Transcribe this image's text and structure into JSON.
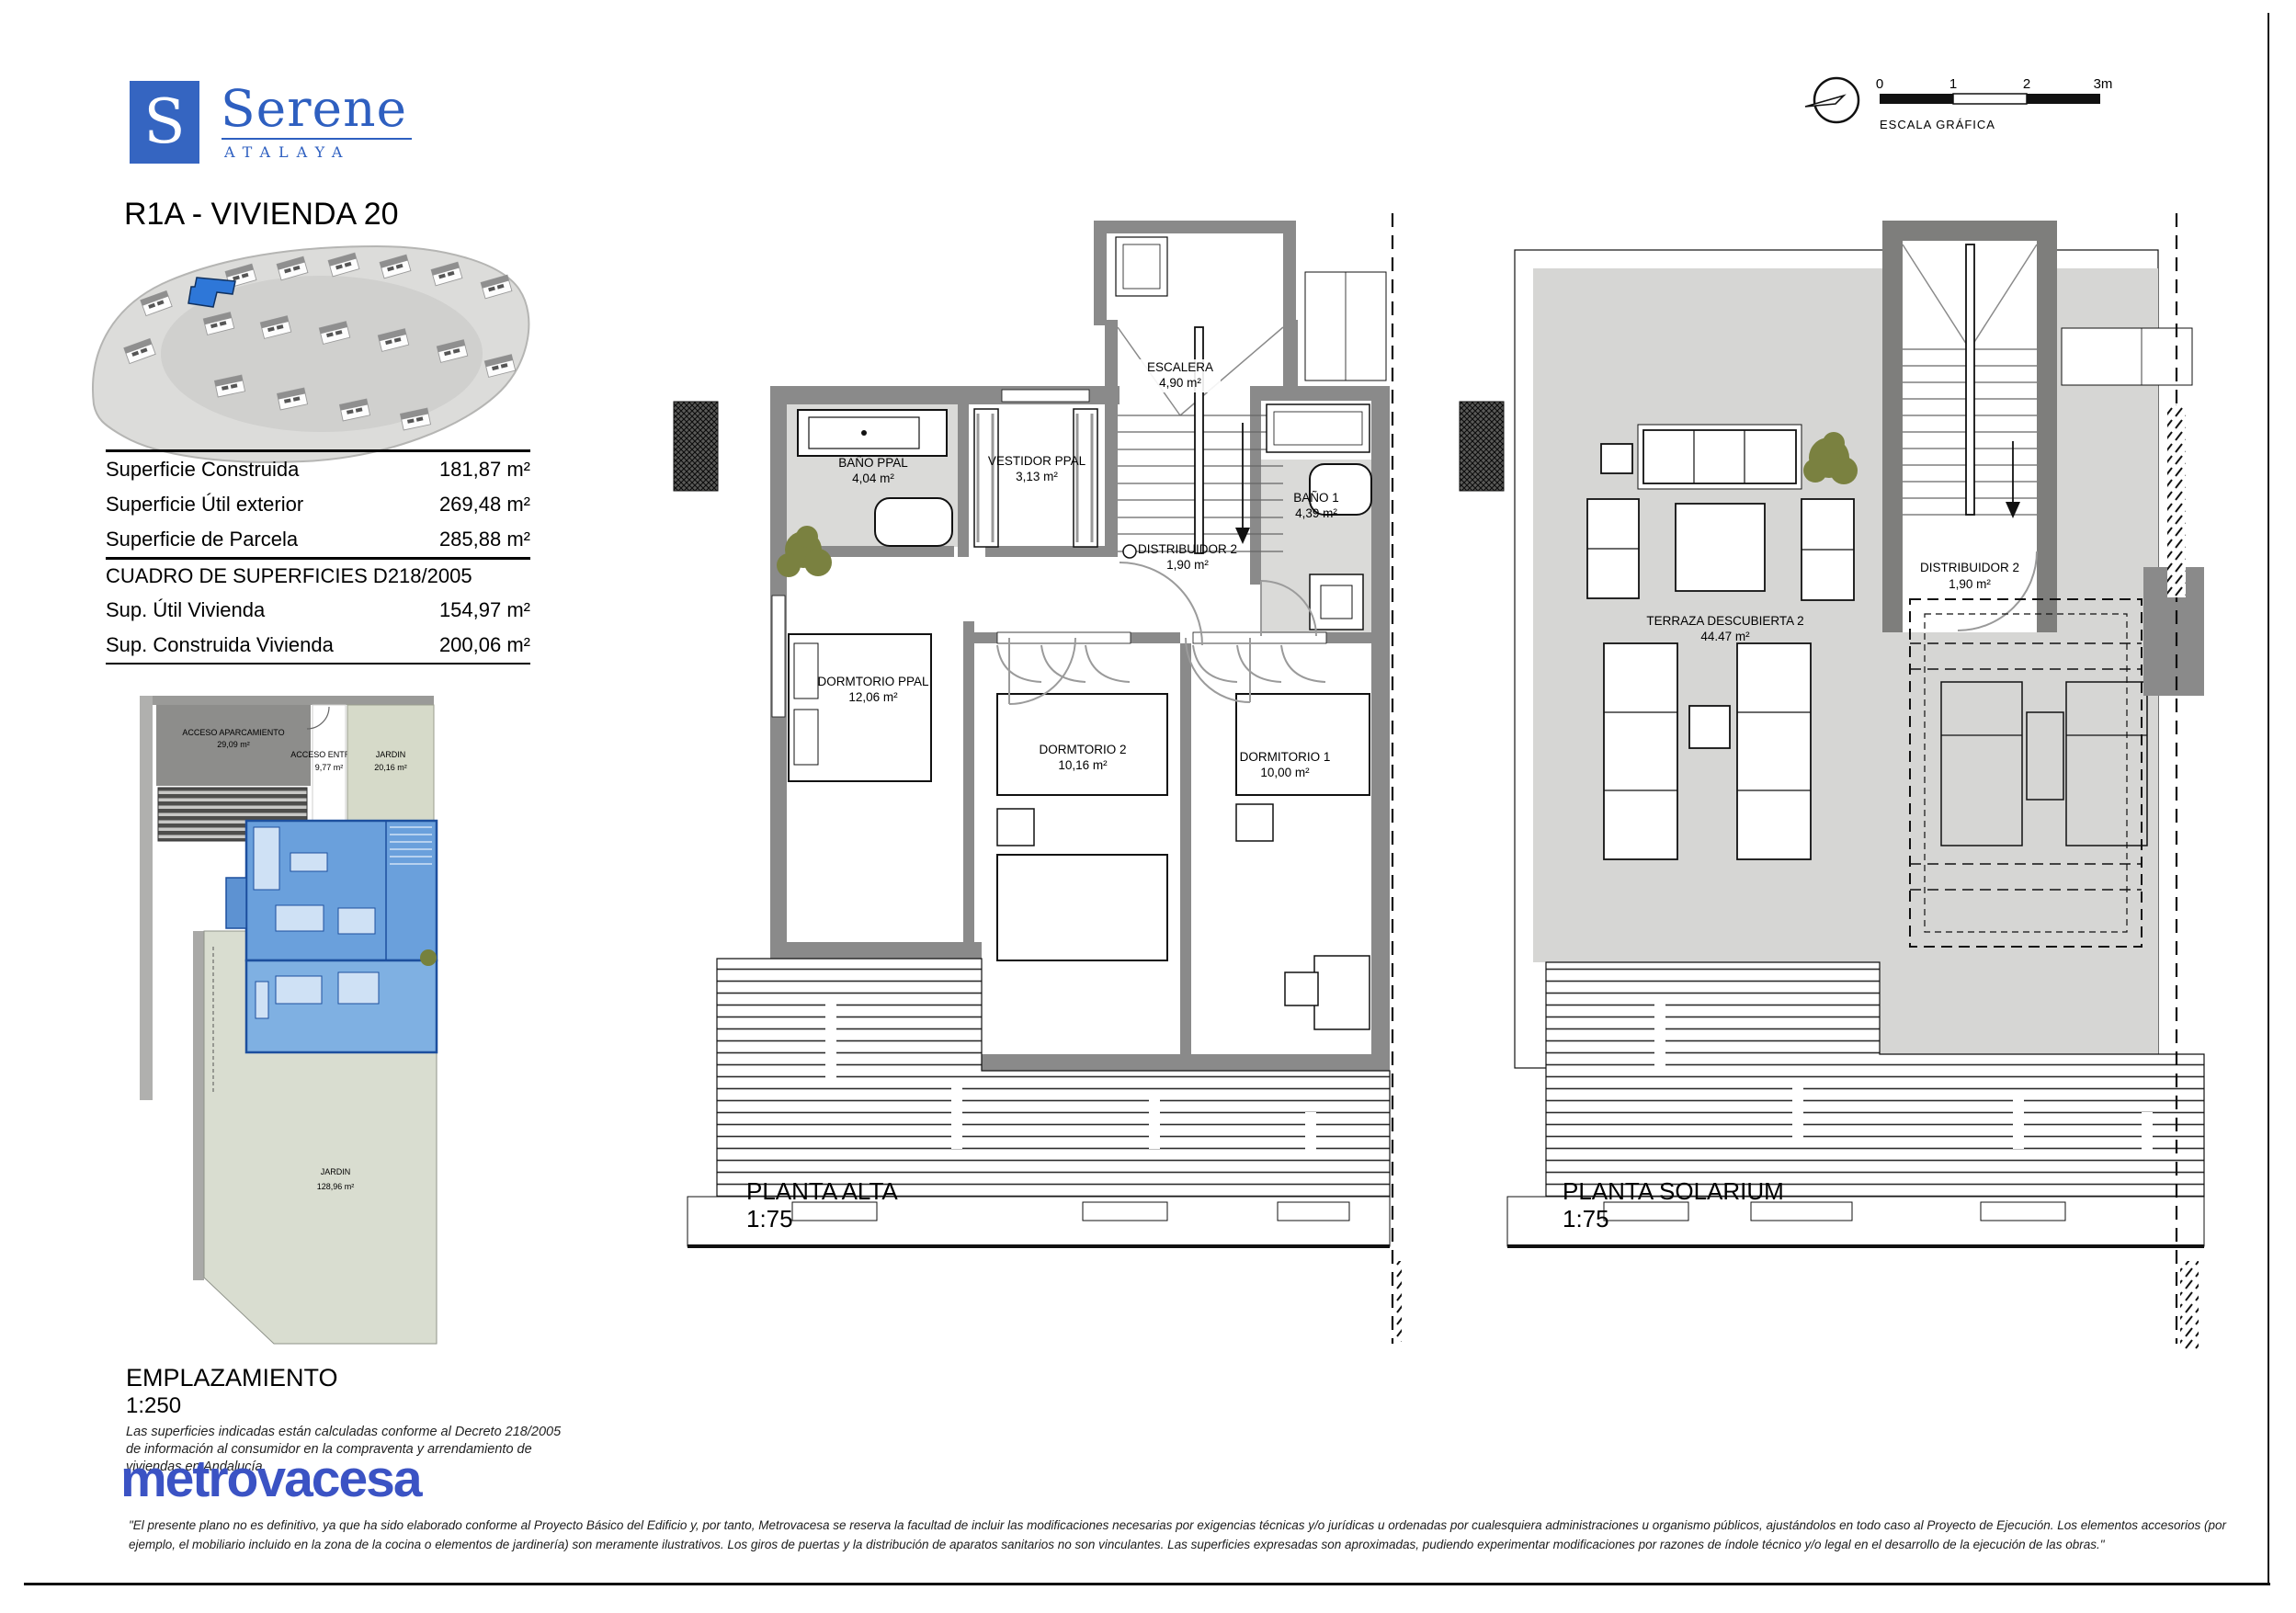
{
  "logo": {
    "initial": "S",
    "brand": "Serene",
    "subbrand": "ATALAYA"
  },
  "title": "R1A - VIVIENDA 20",
  "scalebar": {
    "t0": "0",
    "t1": "1",
    "t2": "2",
    "t3": "3m",
    "caption": "ESCALA GRÁFICA"
  },
  "surface_table": {
    "rows": [
      {
        "label": "Superficie Construida",
        "value": "181,87 m²"
      },
      {
        "label": "Superficie Útil exterior",
        "value": "269,48 m²"
      },
      {
        "label": "Superficie de Parcela",
        "value": "285,88 m²"
      }
    ],
    "section": "CUADRO DE SUPERFICIES D218/2005",
    "rows2": [
      {
        "label": "Sup. Útil Vivienda",
        "value": "154,97 m²"
      },
      {
        "label": "Sup. Construida Vivienda",
        "value": "200,06 m²"
      }
    ]
  },
  "emplazamiento": {
    "title": "EMPLAZAMIENTO",
    "scale": "1:250",
    "areas": {
      "aparcamiento": {
        "name": "ACCESO APARCAMIENTO",
        "area": "29,09 m²"
      },
      "entrada": {
        "name": "ACCESO ENTRADA",
        "area": "9,77 m²"
      },
      "jardin_top": {
        "name": "JARDIN",
        "area": "20,16 m²"
      },
      "jardin_big": {
        "name": "JARDIN",
        "area": "128,96 m²"
      }
    },
    "note": "Las superficies indicadas están calculadas conforme al Decreto 218/2005 de información al consumidor en la compraventa y arrendamiento de viviendas en Andalucía."
  },
  "planta_alta": {
    "title": "PLANTA ALTA",
    "scale": "1:75",
    "rooms": {
      "escalera": {
        "name": "ESCALERA",
        "area": "4,90 m²"
      },
      "bano_ppal": {
        "name": "BAÑO PPAL",
        "area": "4,04 m²"
      },
      "vestidor": {
        "name": "VESTIDOR PPAL",
        "area": "3,13 m²"
      },
      "bano1": {
        "name": "BAÑO 1",
        "area": "4,39 m²"
      },
      "distribuidor": {
        "name": "DISTRIBUIDOR 2",
        "area": "1,90 m²"
      },
      "dorm_ppal": {
        "name": "DORMTORIO PPAL",
        "area": "12,06 m²"
      },
      "dorm2": {
        "name": "DORMTORIO 2",
        "area": "10,16 m²"
      },
      "dorm1": {
        "name": "DORMITORIO 1",
        "area": "10,00 m²"
      }
    }
  },
  "planta_solarium": {
    "title": "PLANTA SOLARIUM",
    "scale": "1:75",
    "rooms": {
      "terraza": {
        "name": "TERRAZA DESCUBIERTA 2",
        "area": "44.47 m²"
      },
      "distribuidor": {
        "name": "DISTRIBUIDOR 2",
        "area": "1,90 m²"
      }
    }
  },
  "footer": {
    "brand": "metrovacesa",
    "disclaimer": "\"El presente plano no es definitivo, ya que ha sido elaborado conforme al Proyecto Básico del Edificio y, por tanto, Metrovacesa se reserva la facultad de incluir las modificaciones necesarias por exigencias técnicas y/o jurídicas u ordenadas por cualesquiera administraciones u organismo públicos, ajustándolos en todo caso al Proyecto de Ejecución. Los elementos accesorios (por ejemplo, el mobiliario incluido en la zona de la cocina o elementos de jardinería) son meramente ilustrativos. Los giros de puertas y la distribución de aparatos sanitarios no son vinculantes. Las superficies expresadas son aproximadas, pudiendo experimentar modificaciones por razones de índole técnico y/o legal en el desarrollo de la ejecución de las obras.\""
  },
  "colors": {
    "brand_blue": "#2e5fc0",
    "metrovacesa_blue": "#3b53c4",
    "wall_gray": "#8a8a8a",
    "floor_gray": "#dadad8",
    "garden_green": "#d9ddd0",
    "highlight_blue": "#5e9ad8"
  }
}
